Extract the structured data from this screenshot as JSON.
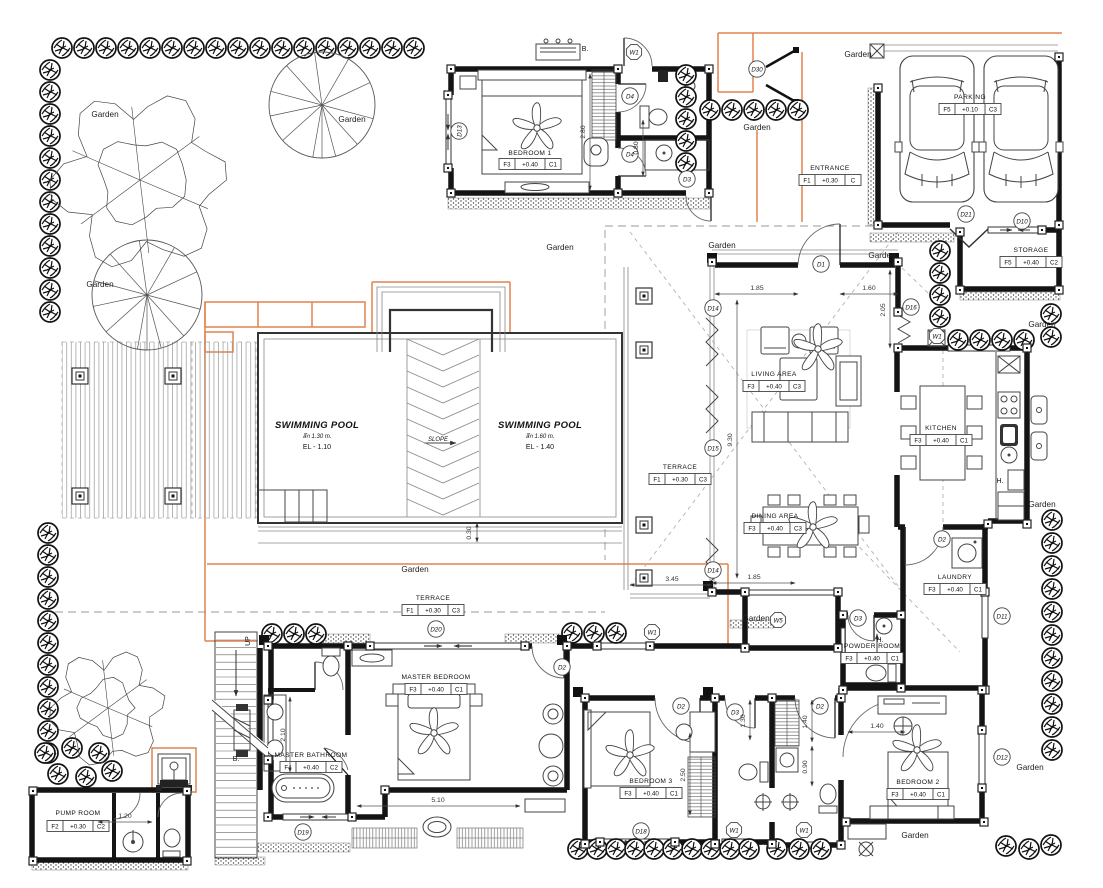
{
  "plan": {
    "garden_label": "Garden",
    "up_label": "UP",
    "b_label": "B.",
    "bx2_label": "B.X2",
    "h_label": "H.",
    "slope_label": "SLOPE",
    "rooms": [
      {
        "name": "BEDROOM 1",
        "tag": [
          "F3",
          "+0.40",
          "C1"
        ]
      },
      {
        "name": "PARKING",
        "tag": [
          "F5",
          "+0.10",
          "C3"
        ]
      },
      {
        "name": "ENTRANCE",
        "tag": [
          "F1",
          "+0.30",
          "C"
        ]
      },
      {
        "name": "STORAGE",
        "tag": [
          "F5",
          "+0.40",
          "C2"
        ]
      },
      {
        "name": "LIVING AREA",
        "tag": [
          "F3",
          "+0.40",
          "C3"
        ]
      },
      {
        "name": "KITCHEN",
        "tag": [
          "F3",
          "+0.40",
          "C1"
        ]
      },
      {
        "name": "TERRACE",
        "tag": [
          "F1",
          "+0.30",
          "C3"
        ]
      },
      {
        "name": "DINING AREA",
        "tag": [
          "F3",
          "+0.40",
          "C3"
        ]
      },
      {
        "name": "LAUNDRY",
        "tag": [
          "F3",
          "+0.40",
          "C1"
        ]
      },
      {
        "name": "POWDER ROOM",
        "tag": [
          "F3",
          "+0.40",
          "C1"
        ]
      },
      {
        "name": "TERRACE",
        "tag": [
          "F1",
          "+0.30",
          "C3"
        ]
      },
      {
        "name": "MASTER BEDROOM",
        "tag": [
          "F3",
          "+0.40",
          "C1"
        ]
      },
      {
        "name": "MASTER BATHROOM",
        "tag": [
          "F4",
          "+0.40",
          "C2"
        ]
      },
      {
        "name": "BEDROOM 3",
        "tag": [
          "F3",
          "+0.40",
          "C1"
        ]
      },
      {
        "name": "BEDROOM 2",
        "tag": [
          "F3",
          "+0.40",
          "C1"
        ]
      },
      {
        "name": "PUMP ROOM",
        "tag": [
          "F2",
          "+0.30",
          "C2"
        ]
      }
    ],
    "pools": [
      {
        "title": "SWIMMING POOL",
        "depth": "ลึก 1.30 m.",
        "level": "EL - 1.10"
      },
      {
        "title": "SWIMMING POOL",
        "depth": "ลึก 1.60 m.",
        "level": "EL - 1.40"
      }
    ],
    "door_tags": [
      "D13",
      "W1",
      "D4",
      "D4",
      "D3",
      "D30",
      "D1",
      "D21",
      "D10",
      "D16",
      "W1",
      "D14",
      "D15",
      "D14",
      "D2",
      "D11",
      "D3",
      "D2",
      "D20",
      "W1",
      "W5",
      "D19",
      "D2",
      "D3",
      "D2",
      "D18",
      "W1",
      "W1",
      "D12"
    ],
    "dimensions": [
      "2.80",
      "0.80",
      "1.85",
      "1.60",
      "2.05",
      "9.30",
      "3.45",
      "1.85",
      "0.30",
      "2.10",
      "5.10",
      "2.50",
      "1.30",
      "1.40",
      "0.90",
      "1.40",
      "1.20"
    ]
  }
}
